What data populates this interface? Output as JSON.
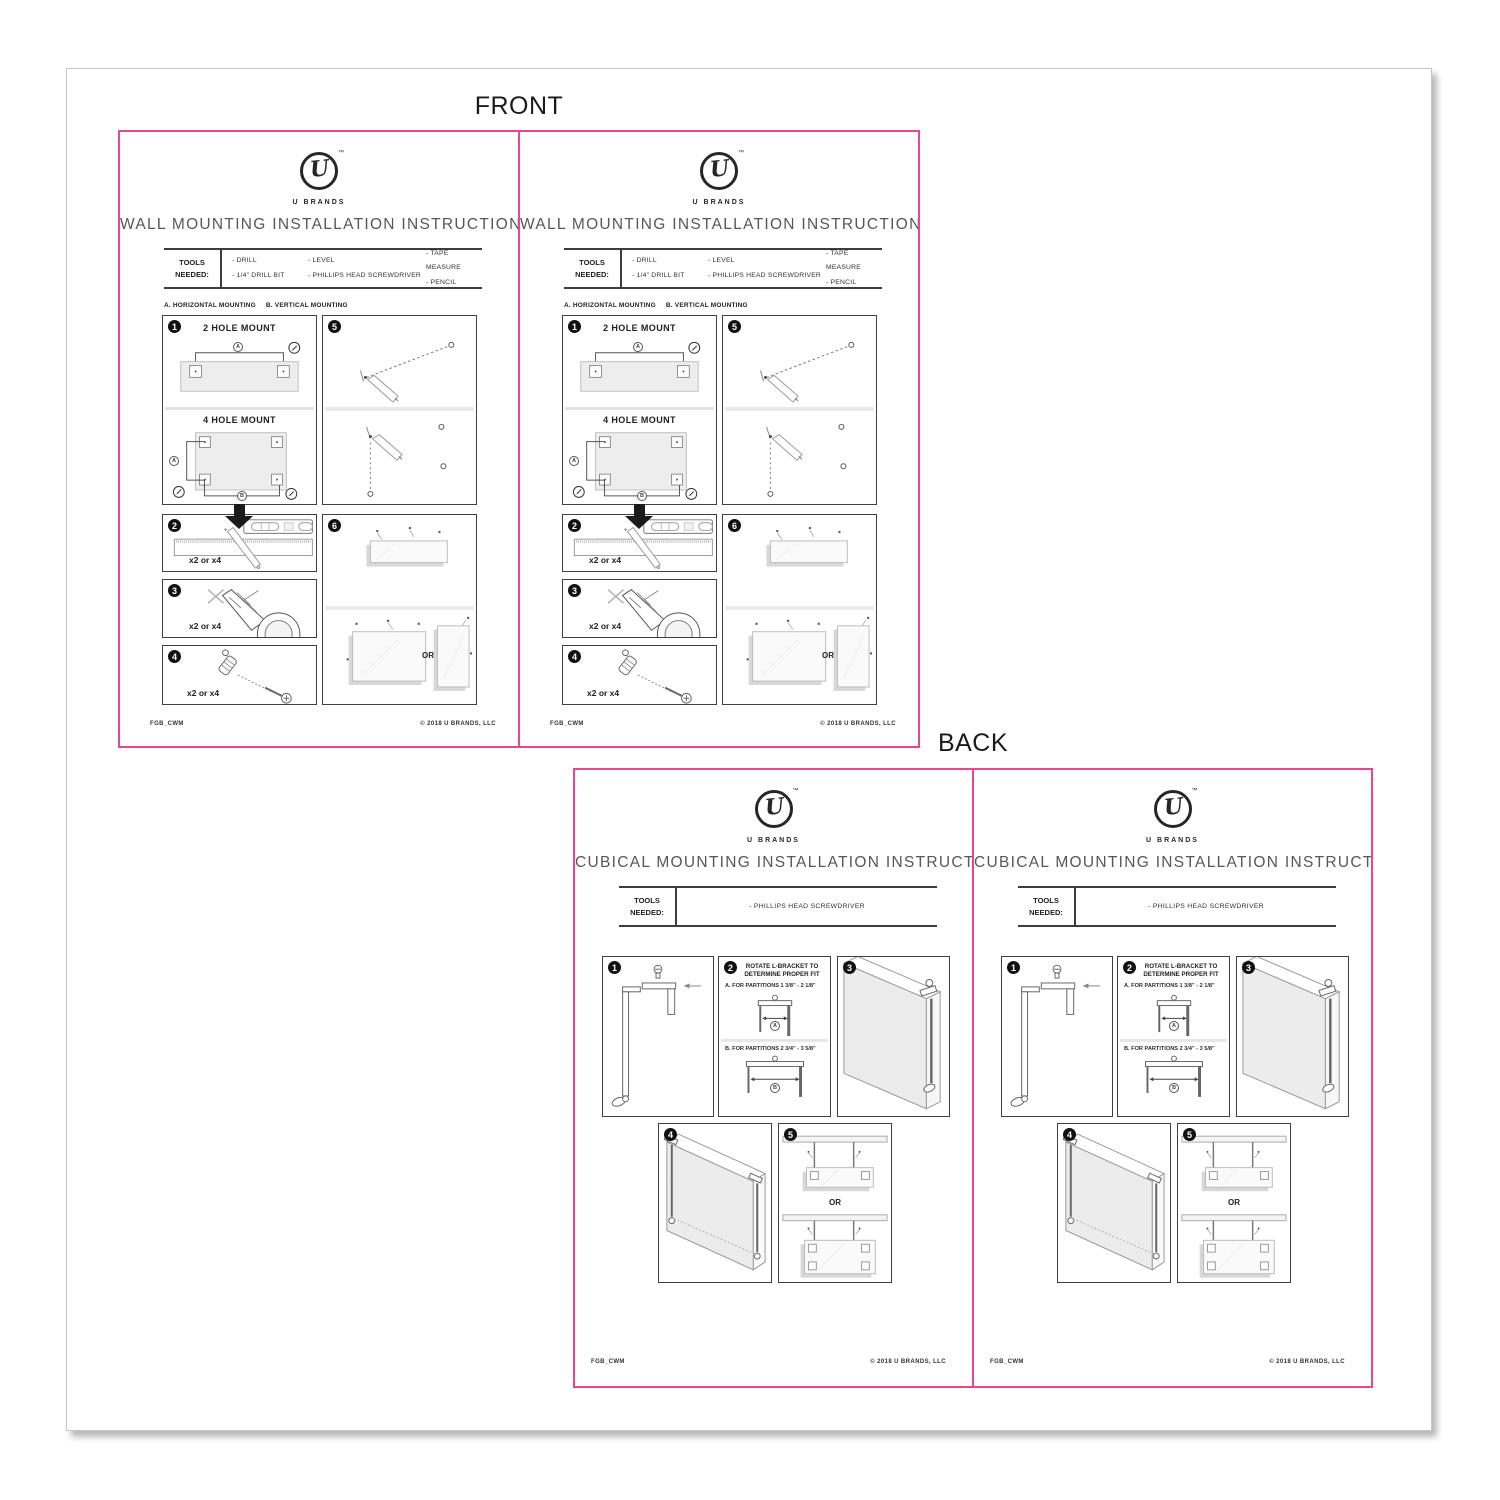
{
  "labels": {
    "front": "FRONT",
    "back": "BACK"
  },
  "brand": {
    "monogram": "U",
    "tm": "™",
    "name": "U BRANDS"
  },
  "colors": {
    "accent_pink": "#E8478B",
    "ink": "#2E2E2E",
    "title_gray": "#575757",
    "board_gray": "#EDEDED"
  },
  "wall": {
    "title": "WALL MOUNTING INSTALLATION INSTRUCTIONS",
    "tools_label": "TOOLS NEEDED:",
    "tools_col1": [
      "- DRILL",
      "- 1/4\" DRILL BIT"
    ],
    "tools_col2": [
      "- LEVEL",
      "- PHILLIPS HEAD SCREWDRIVER"
    ],
    "tools_col3": [
      "- TAPE MEASURE",
      "- PENCIL"
    ],
    "note_a": "A. HORIZONTAL MOUNTING",
    "note_b": "B. VERTICAL MOUNTING",
    "step1_num": "1",
    "step2_num": "2",
    "step3_num": "3",
    "step4_num": "4",
    "step5_num": "5",
    "step6_num": "6",
    "two_hole_label": "2 HOLE MOUNT",
    "four_hole_label": "4 HOLE MOUNT",
    "dim_a": "A",
    "dim_b": "B",
    "qty_label": "x2 or x4",
    "or_label": "OR",
    "footer_left": "FGB_CWM",
    "footer_right": "© 2018 U BRANDS, LLC"
  },
  "cubical": {
    "title": "CUBICAL MOUNTING INSTALLATION INSTRUCTIONS",
    "tools_label": "TOOLS NEEDED:",
    "tool_item": "- PHILLIPS HEAD SCREWDRIVER",
    "step1_num": "1",
    "step2_num": "2",
    "step3_num": "3",
    "step4_num": "4",
    "step5_num": "5",
    "rotate_line1": "ROTATE L-BRACKET TO",
    "rotate_line2": "DETERMINE PROPER FIT",
    "option_a": "A. FOR PARTITIONS  1 3/8\" - 2 1/8\"",
    "option_b": "B. FOR PARTITIONS  2 3/4\" - 3 5/8\"",
    "dim_a": "A",
    "dim_b": "B",
    "or_label": "OR",
    "footer_left": "FGB_CWM",
    "footer_right": "© 2018 U BRANDS, LLC"
  }
}
